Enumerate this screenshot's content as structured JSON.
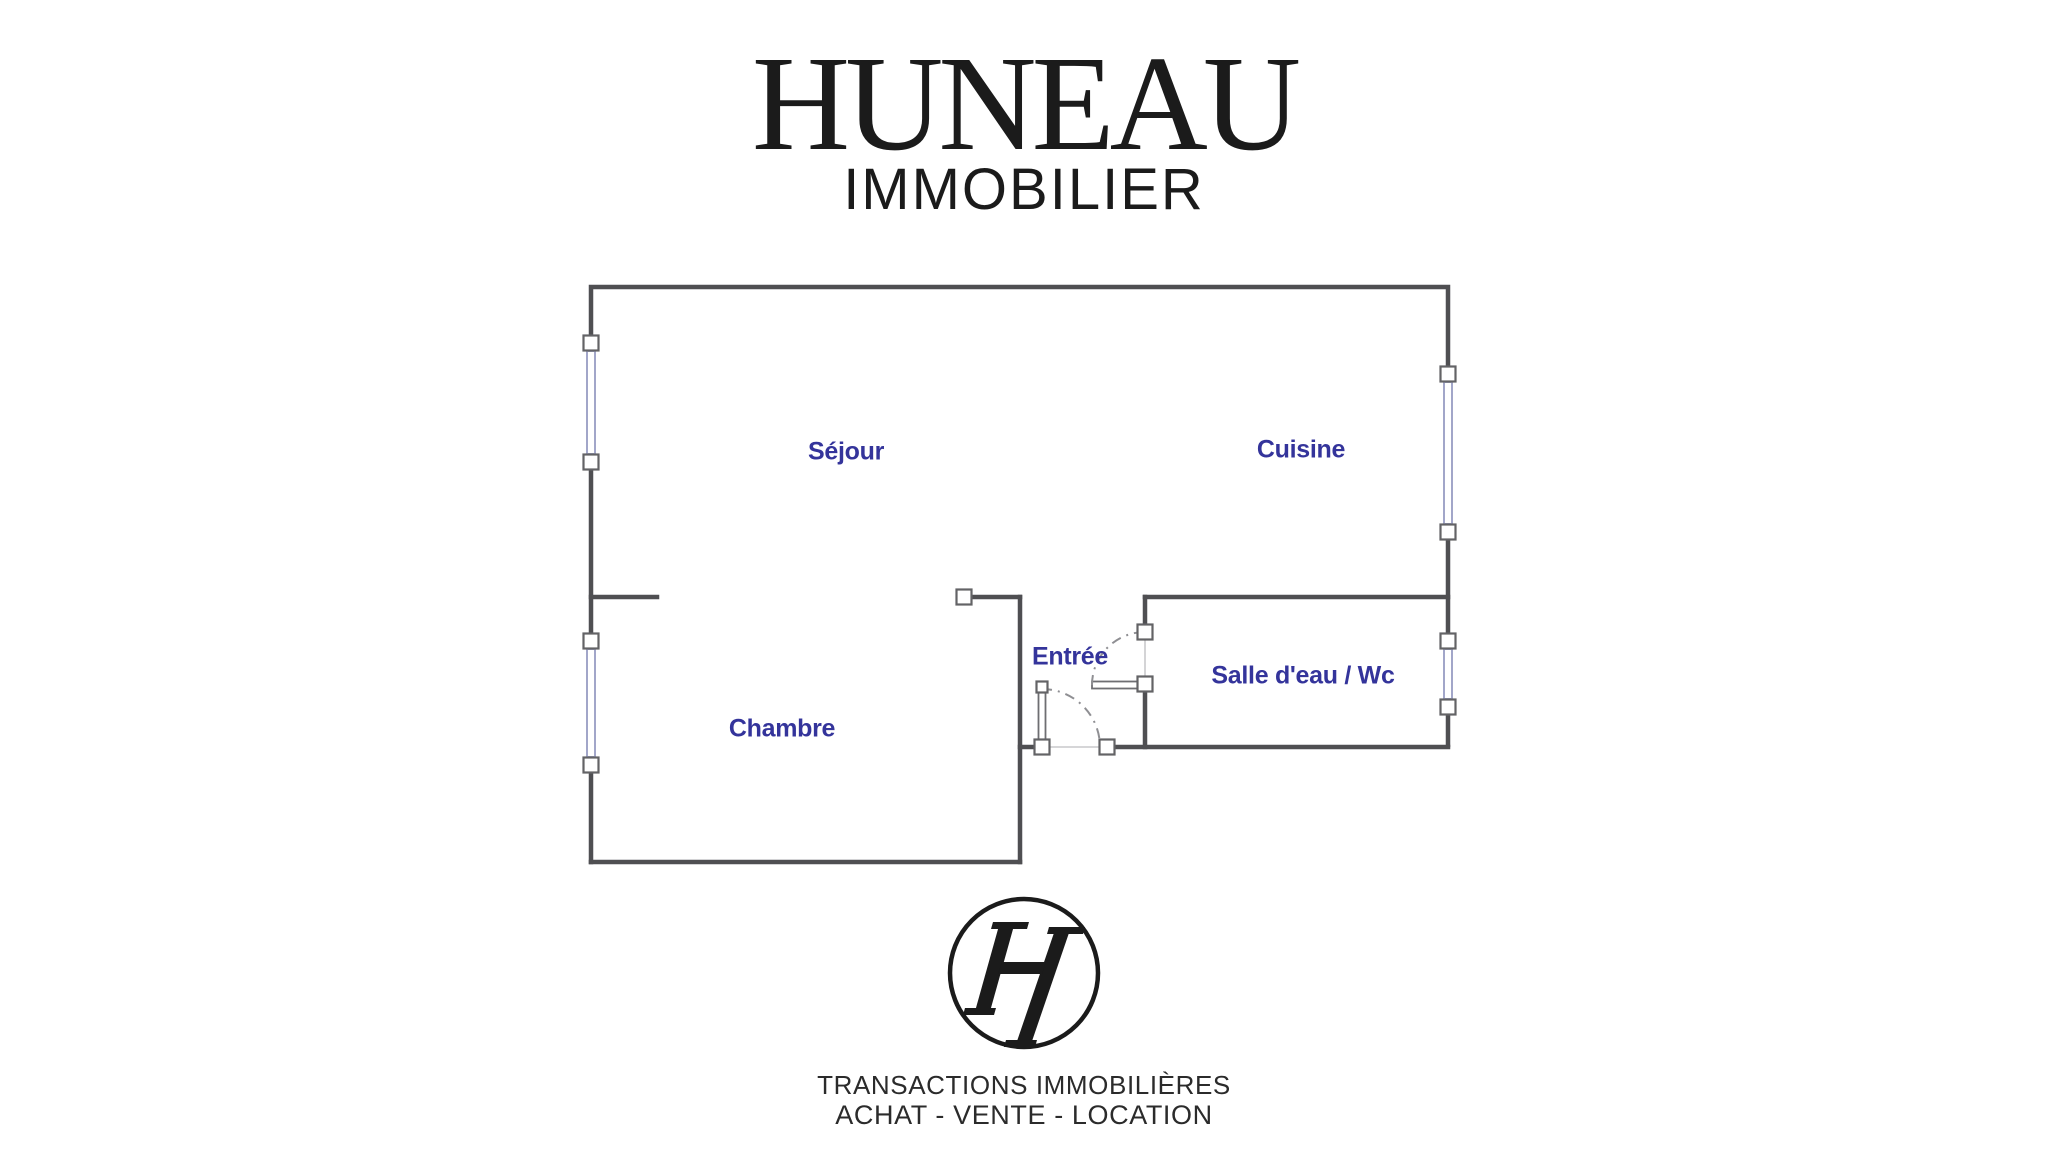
{
  "colors": {
    "page_bg": "#ffffff",
    "ink": "#1b1b1b",
    "footer_ink": "#2b2b2b",
    "label": "#34349b",
    "wall": "#4f4f52",
    "window": "#a2a6c9",
    "handle_border": "#636366",
    "door_leaf": "#6e6e72",
    "door_arc": "#8f8f93",
    "opening": "#c9c9cc"
  },
  "header": {
    "brand": "HUNEAU",
    "subtitle": "IMMOBILIER"
  },
  "floorplan": {
    "rooms": [
      {
        "name": "sejour",
        "label": "Séjour"
      },
      {
        "name": "cuisine",
        "label": "Cuisine"
      },
      {
        "name": "chambre",
        "label": "Chambre"
      },
      {
        "name": "entree",
        "label": "Entrée"
      },
      {
        "name": "salle-deau-wc",
        "label": "Salle d'eau / Wc"
      }
    ]
  },
  "footer": {
    "monogram": "H",
    "line1": "TRANSACTIONS IMMOBILIÈRES",
    "line2": "ACHAT - VENTE - LOCATION"
  }
}
